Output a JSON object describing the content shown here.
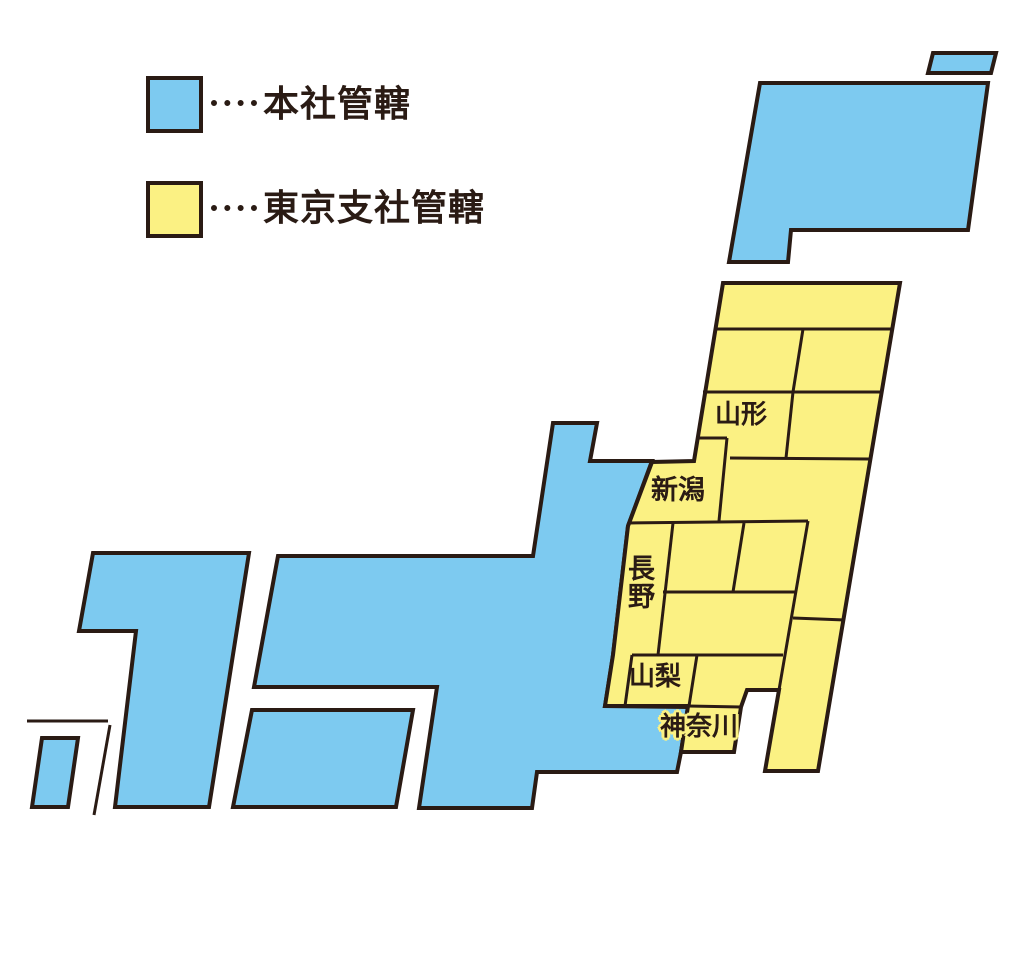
{
  "legend": {
    "items": [
      {
        "id": "headquarters",
        "label": "本社管轄",
        "swatch_color": "#7dcaf0"
      },
      {
        "id": "tokyo-branch",
        "label": "東京支社管轄",
        "swatch_color": "#fbf183"
      }
    ]
  },
  "map": {
    "labels": {
      "yamagata": "山形",
      "niigata": "新潟",
      "nagano": "長野",
      "yamanashi": "山梨",
      "kanagawa": "神奈川"
    }
  },
  "colors": {
    "headquarters_area": "#7dcaf0",
    "tokyo_branch_area": "#fbf183",
    "outline": "#2a1b14",
    "background": "#ffffff"
  }
}
